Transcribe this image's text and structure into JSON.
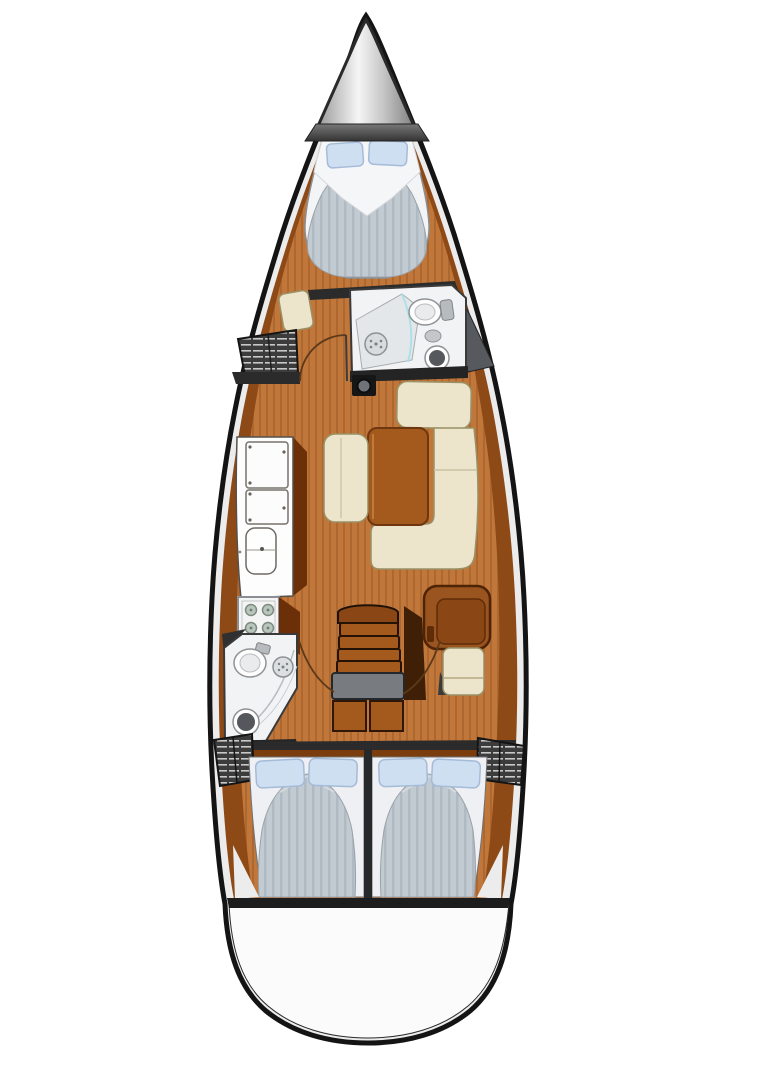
{
  "title": "Sailing yacht interior deck plan (top view)",
  "palette": {
    "hull_outline": "#141414",
    "deck": "#ececec",
    "hull_side": "#8e4a16",
    "floor": "#c1763a",
    "floor_stripe": "#ad6730",
    "wood_dark": "#6b3008",
    "furniture": "#ece5cc",
    "furniture_border": "#9a9166",
    "table": "#a4591d",
    "mattress": "#c3cbd2",
    "mattress_stripe": "#b0bac3",
    "sheet": "#f3f4f6",
    "pillow": "#cfdff2",
    "pillow_border": "#a5bbd8",
    "locker": "#3c3c3c",
    "locker_slat": "#c8c8c8",
    "bath": "#f2f3f5",
    "fixture": "#d9dcdf",
    "bulkhead": "#2b2b2b",
    "stern": "#fbfbfb"
  },
  "boat": {
    "view": "overhead interior layout",
    "rooms": [
      {
        "id": "bow",
        "name": "bow with anchor locker"
      },
      {
        "id": "v-berth",
        "name": "forward V-berth cabin",
        "pillows": 2
      },
      {
        "id": "forward-head",
        "name": "forward head (bathroom)",
        "fixtures": [
          "shower",
          "toilet",
          "sink"
        ]
      },
      {
        "id": "salon",
        "name": "main salon",
        "furniture": [
          "u-settee",
          "table",
          "bench"
        ]
      },
      {
        "id": "galley",
        "name": "port galley",
        "fixtures": [
          "counter-lockers",
          "double-sink",
          "stove-4-burner"
        ]
      },
      {
        "id": "nav-station",
        "name": "navigation station",
        "furniture": [
          "chart-table",
          "seat"
        ]
      },
      {
        "id": "companionway",
        "name": "companionway stairs",
        "steps": 4
      },
      {
        "id": "aft-head",
        "name": "aft head (bathroom)",
        "fixtures": [
          "toilet",
          "shower",
          "sink"
        ]
      },
      {
        "id": "aft-cabin-port",
        "name": "aft double berth (port)",
        "pillows": 2
      },
      {
        "id": "aft-cabin-starboard",
        "name": "aft double berth (starboard)",
        "pillows": 2
      },
      {
        "id": "stern",
        "name": "stern / transom platform"
      }
    ],
    "hanging_lockers": 3
  }
}
